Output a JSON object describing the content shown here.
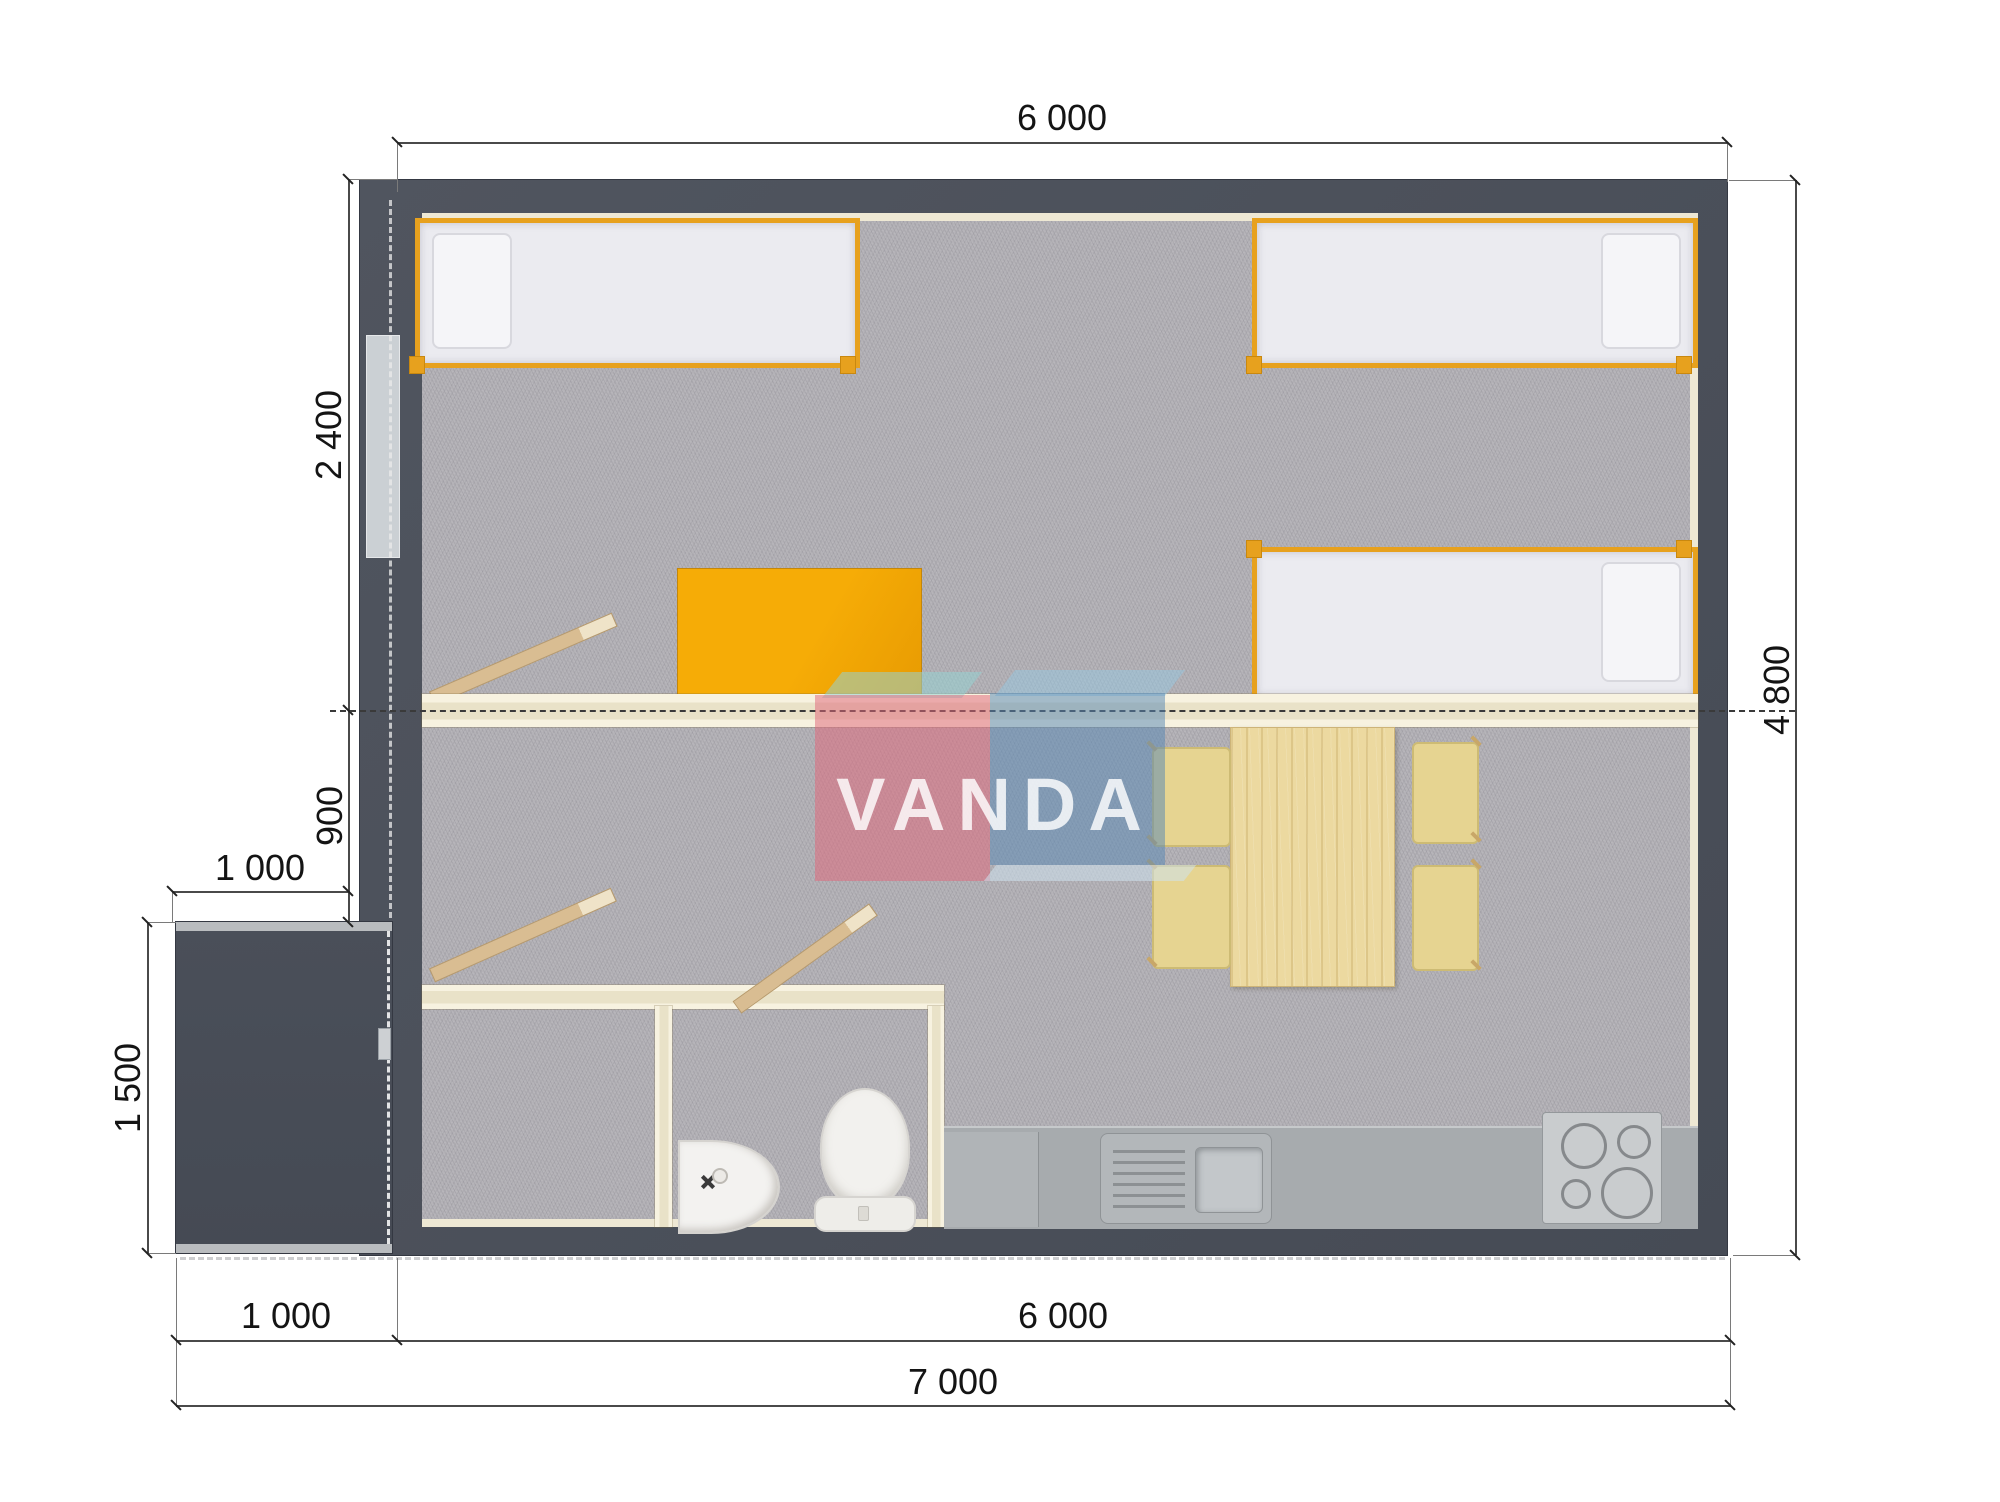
{
  "watermark": {
    "text": "VANDA"
  },
  "dimensions": {
    "top_width": "6 000",
    "right_height": "4 800",
    "left_upper": "2 400",
    "left_lower": "900",
    "porch_width_top": "1 000",
    "porch_height": "1 500",
    "bottom_porch": "1 000",
    "bottom_main": "6 000",
    "bottom_total": "7 000"
  },
  "plan": {
    "type": "floor-plan-top-view",
    "furniture": [
      "single-bed",
      "single-bed",
      "single-bed",
      "desk",
      "dining-table",
      "chair",
      "chair",
      "chair",
      "chair",
      "bathroom-sink",
      "toilet",
      "kitchen-counter",
      "kitchen-sink",
      "stove-4-burners",
      "entry-door",
      "porch"
    ]
  },
  "colors": {
    "wall": "#4d525d",
    "carpet": "#b4b2b7",
    "interior_partition": "#eee8d4",
    "bed_frame": "#e7a11e",
    "desk": "#f0a303",
    "table_wood": "#ecd9a0",
    "chair": "#e6d491",
    "kitchen_counter": "#a7abae",
    "watermark_pink": "#dd6978",
    "watermark_blue": "#5888b4",
    "watermark_teal": "#96d2d2"
  }
}
